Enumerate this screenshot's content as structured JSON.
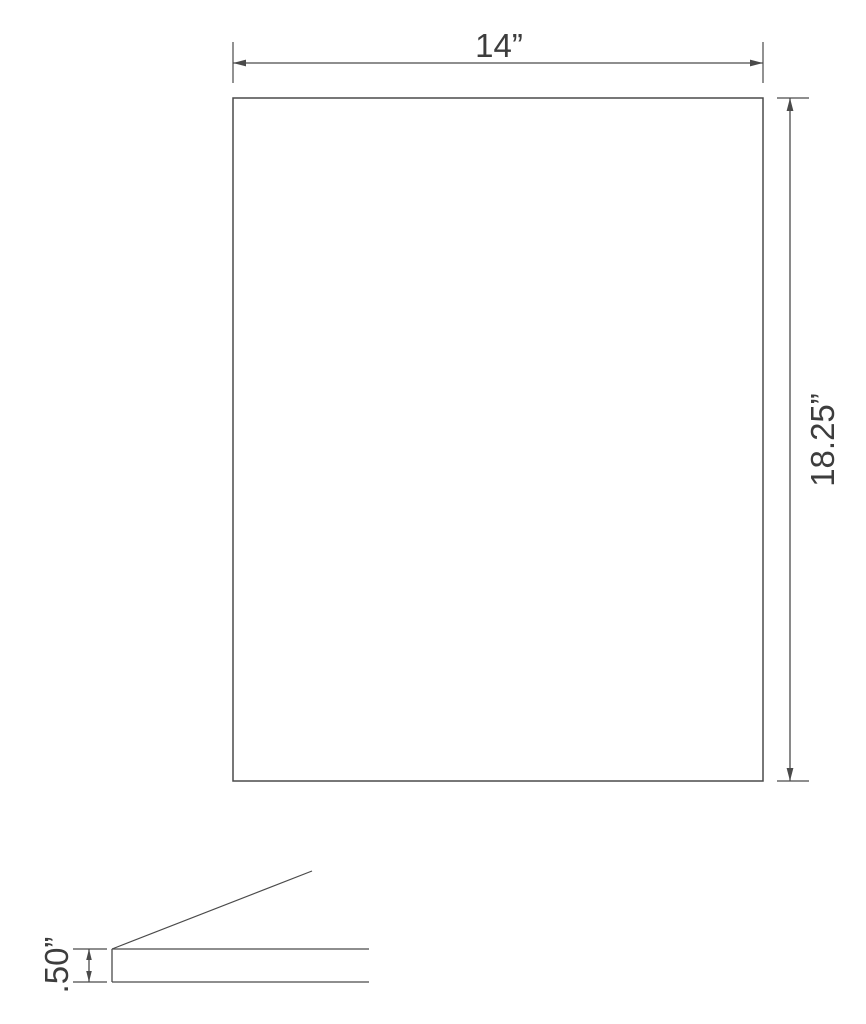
{
  "drawing": {
    "front_view": {
      "width_label": "14”",
      "height_label": "18.25”"
    },
    "side_view": {
      "thickness_label": ".50”"
    },
    "colors": {
      "line": "#4a4a4a",
      "text": "#3d3d3d",
      "background": "#ffffff"
    }
  }
}
